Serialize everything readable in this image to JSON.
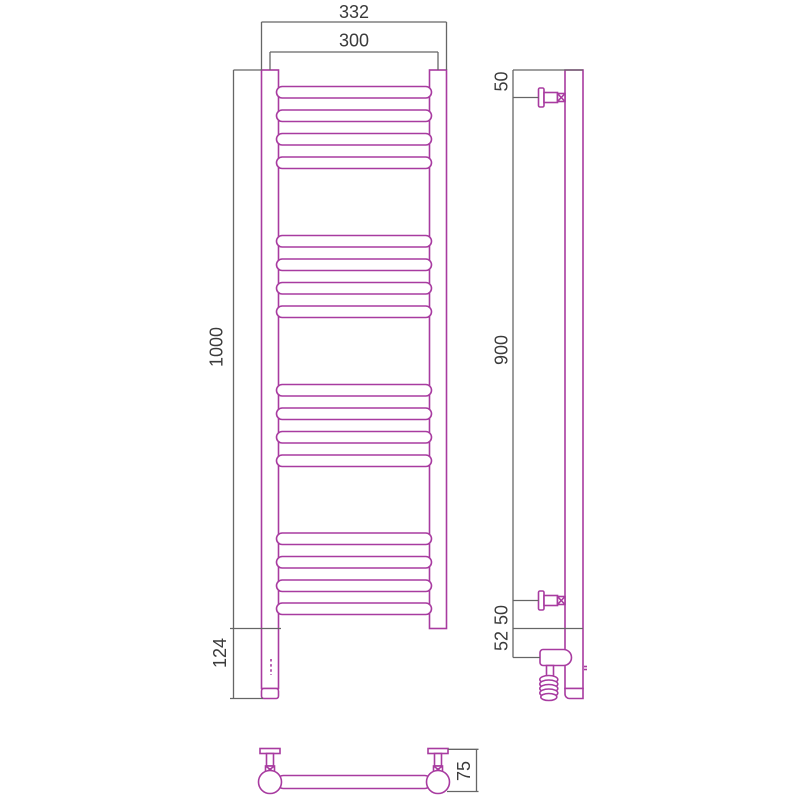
{
  "drawing": {
    "colors": {
      "product": "#a83ba0",
      "dimension": "#666666",
      "label": "#3b3b3b",
      "background": "#ffffff"
    },
    "front_view": {
      "width_overall": "332",
      "width_centers": "300",
      "height_overall": "1000",
      "bottom_extension": "124"
    },
    "side_view": {
      "top_bracket_offset": "50",
      "bracket_spacing": "900",
      "bottom_bracket_offset": "50",
      "heater_offset": "52"
    },
    "top_view": {
      "depth": "75"
    }
  }
}
